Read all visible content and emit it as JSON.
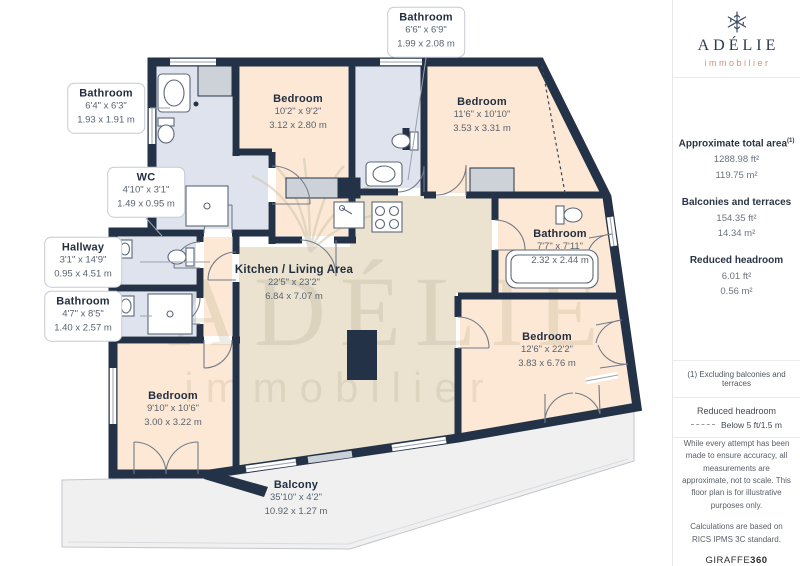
{
  "brand": {
    "name": "ADÉLIE",
    "tagline": "immobilier"
  },
  "watermark": {
    "line1": "ADÉLIE",
    "line2": "immobilier"
  },
  "rooms": {
    "bathroom_top": {
      "name": "Bathroom",
      "imperial": "6'6\" x 6'9\"",
      "metric": "1.99 x 2.08 m"
    },
    "bathroom_top_left": {
      "name": "Bathroom",
      "imperial": "6'4\" x 6'3\"",
      "metric": "1.93 x 1.91 m"
    },
    "wc": {
      "name": "WC",
      "imperial": "4'10\" x 3'1\"",
      "metric": "1.49 x 0.95 m"
    },
    "hallway": {
      "name": "Hallway",
      "imperial": "3'1\" x 14'9\"",
      "metric": "0.95 x 4.51 m"
    },
    "bathroom_left": {
      "name": "Bathroom",
      "imperial": "4'7\" x 8'5\"",
      "metric": "1.40 x 2.57 m"
    },
    "bedroom_top_left": {
      "name": "Bedroom",
      "imperial": "10'2\" x 9'2\"",
      "metric": "3.12 x 2.80 m"
    },
    "bedroom_top_right": {
      "name": "Bedroom",
      "imperial": "11'6\" x 10'10\"",
      "metric": "3.53 x 3.31 m"
    },
    "kitchen_living": {
      "name": "Kitchen / Living Area",
      "imperial": "22'5\" x 23'2\"",
      "metric": "6.84 x 7.07 m"
    },
    "bathroom_right": {
      "name": "Bathroom",
      "imperial": "7'7\" x 7'11\"",
      "metric": "2.32 x 2.44 m"
    },
    "bedroom_right": {
      "name": "Bedroom",
      "imperial": "12'6\" x 22'2\"",
      "metric": "3.83 x 6.76 m"
    },
    "bedroom_bottom_left": {
      "name": "Bedroom",
      "imperial": "9'10\" x 10'6\"",
      "metric": "3.00 x 3.22 m"
    },
    "balcony": {
      "name": "Balcony",
      "imperial": "35'10\" x 4'2\"",
      "metric": "10.92 x 1.27 m"
    }
  },
  "sidebar": {
    "total_area": {
      "title": "Approximate total area",
      "marker": "(1)",
      "ft": "1288.98 ft²",
      "m": "119.75 m²"
    },
    "balconies_terraces": {
      "title": "Balconies and terraces",
      "ft": "154.35 ft²",
      "m": "14.34 m²"
    },
    "reduced_headroom": {
      "title": "Reduced headroom",
      "ft": "6.01 ft²",
      "m": "0.56 m²"
    },
    "footnote": "(1) Excluding balconies and terraces",
    "legend": {
      "title": "Reduced headroom",
      "label": "Below 5 ft/1.5 m"
    },
    "disclaimer": "While every attempt has been made to ensure accuracy, all measurements are approximate, not to scale. This floor plan is for illustrative purposes only.",
    "standard": "Calculations are based on RICS IPMS 3C standard.",
    "credit": {
      "brand": "GIRAFFE",
      "suffix": "360"
    }
  },
  "colors": {
    "wall": "#243247",
    "bedroom": "#fce8d4",
    "living": "#ebe3d0",
    "bathroom": "#dee3ee",
    "balcony": "#f0f0f0",
    "accent": "#d4907c"
  }
}
